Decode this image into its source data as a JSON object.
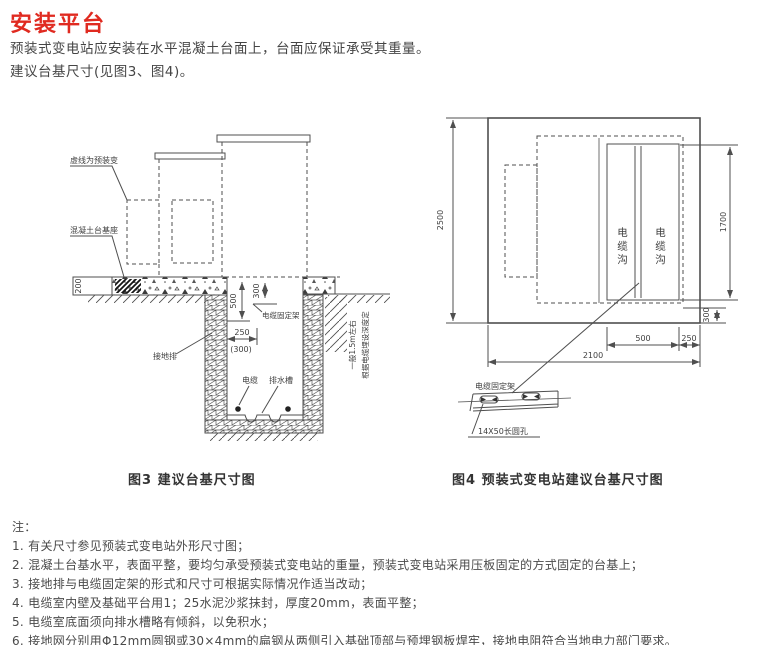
{
  "page": {
    "title": "安装平台",
    "intro1": "预装式变电站应安装在水平混凝土台面上，台面应保证承受其重量。",
    "intro2": "建议台基尺寸(见图3、图4)。"
  },
  "fig3": {
    "caption": "图3  建议台基尺寸图",
    "labels": {
      "dashed_note": "虚线为预装变",
      "concrete_base": "混凝土台基座",
      "ground_bar": "接地排",
      "cable_bracket": "电缆固定架",
      "cable": "电缆",
      "drain": "排水槽",
      "depth_note1": "一般1.5m左右",
      "depth_note2": "根据电缆埋设深度定"
    },
    "dims": {
      "d200": "200",
      "d500": "500",
      "d300": "300",
      "d250": "250",
      "d250_alt": "(300)"
    }
  },
  "fig4": {
    "caption": "图4  预装式变电站建议台基尺寸图",
    "labels": {
      "trench_left": "电缆沟",
      "trench_right": "电缆沟",
      "cable_bracket": "电缆固定架",
      "hole": "14X50长圆孔"
    },
    "dims": {
      "d2500": "2500",
      "d1700": "1700",
      "d300": "300",
      "d500": "500",
      "d250": "250",
      "d2100": "2100"
    }
  },
  "notes": {
    "heading": "注：",
    "items": [
      "1. 有关尺寸参见预装式变电站外形尺寸图；",
      "2. 混凝土台基水平，表面平整，要均匀承受预装式变电站的重量，预装式变电站采用压板固定的方式固定的台基上；",
      "3. 接地排与电缆固定架的形式和尺寸可根据实际情况作适当改动；",
      "4. 电缆室内壁及基础平台用1；25水泥沙浆抹封，厚度20mm，表面平整；",
      "5. 电缆室底面须向排水槽略有倾斜，以免积水；",
      "6. 接地网分别用Φ12mm圆钢或30×4mm的扁钢从两侧引入基础顶部与预埋钢板焊牢，接地电阻符合当地电力部门要求。"
    ]
  },
  "colors": {
    "title_red": "#e02a20",
    "text": "#454545",
    "line": "#4f4f4f"
  }
}
